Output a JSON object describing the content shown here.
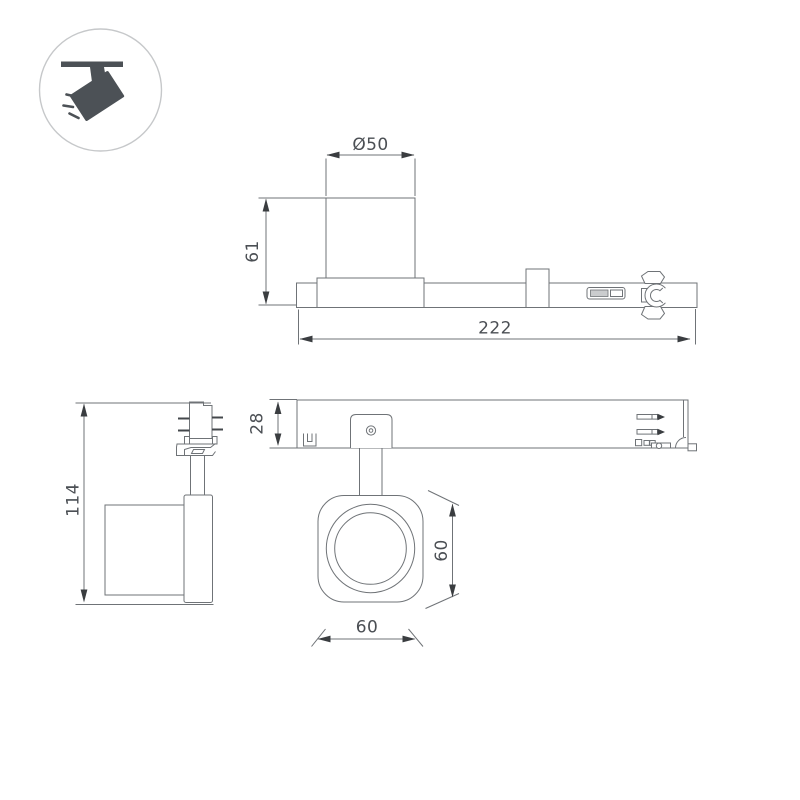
{
  "page": {
    "background": "#ffffff",
    "kind": "technical-dimension-drawing"
  },
  "colors": {
    "outline": "#6f7377",
    "dark_detail": "#44484c",
    "arrow": "#3a3d40",
    "text": "#4b4f54",
    "icon_fill": "#4c5156",
    "icon_ring": "#c6c8ca",
    "switch_fill": "#caccce"
  },
  "icon": {
    "name": "ceiling-track-spotlight-icon"
  },
  "views": {
    "side": {
      "label": "side-view-on-track",
      "dims": {
        "diameter": "Ø50",
        "height": "61",
        "length": "222"
      }
    },
    "front": {
      "label": "front-view",
      "dims": {
        "height": "114"
      }
    },
    "plan": {
      "label": "underside-view",
      "dims": {
        "rail_height": "28",
        "head_width": "60",
        "head_height": "60"
      }
    }
  }
}
